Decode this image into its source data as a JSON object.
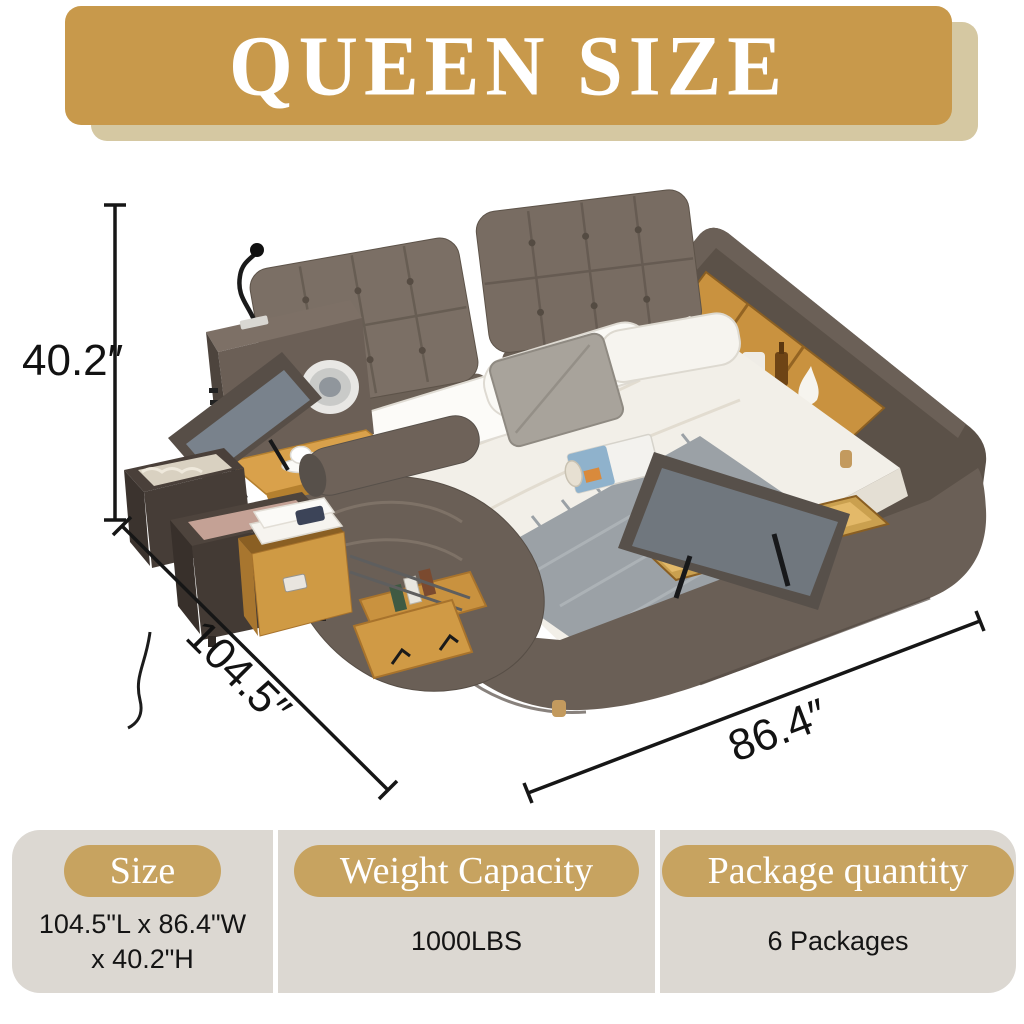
{
  "banner": {
    "title": "QUEEN SIZE"
  },
  "dimensions": {
    "height_label": "40.2″",
    "length_label": "104.5″",
    "width_label": "86.4″"
  },
  "specs": {
    "size": {
      "header": "Size",
      "value": "104.5\"L x 86.4\"W\nx 40.2\"H"
    },
    "weight": {
      "header": "Weight Capacity",
      "value": "1000LBS"
    },
    "packages": {
      "header": "Package quantity",
      "value": "6 Packages"
    }
  },
  "colors": {
    "banner_gold": "#C8994B",
    "banner_shadow": "#D5C8A2",
    "pill_gold": "#C7A360",
    "panel_background": "#DCD8D2",
    "dimension_line": "#161616",
    "bed_leather": "#6A5F56",
    "wood": "#C9923F"
  }
}
